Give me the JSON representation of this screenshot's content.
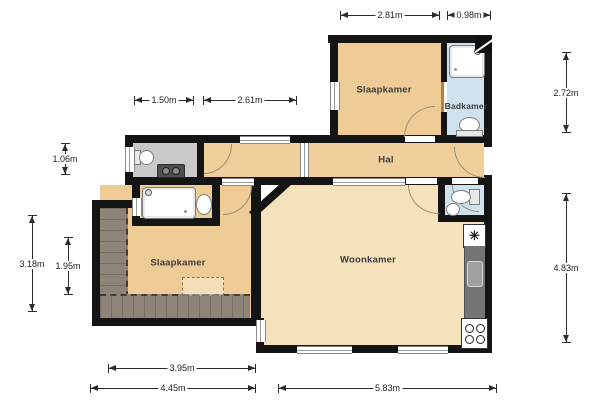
{
  "plan": {
    "rooms": {
      "bedroom_top": "Slaapkamer",
      "bathroom_top": "Badkamer",
      "hall": "Hal",
      "bedroom_left": "Slaapkamer",
      "living_room": "Woonkamer"
    },
    "dimensions": {
      "top_a": "2.81m",
      "top_b": "0.98m",
      "inner_a": "1.50m",
      "inner_b": "2.61m",
      "left_a": "1.06m",
      "left_b": "3.18m",
      "left_c": "1.95m",
      "right_a": "2.72m",
      "right_b": "4.83m",
      "bottom_a": "3.95m",
      "bottom_b": "4.45m",
      "bottom_c": "5.83m"
    },
    "symbols": {
      "fridge": "✳"
    },
    "colors": {
      "wall": "#141414",
      "room_tan": "#efcc96",
      "room_tan_light": "#f5e2bb",
      "bathroom_blue": "#cfe3ef",
      "wc_gray": "#c9c9c9",
      "slope_gray": "#8d8378",
      "counter_gray": "#757575"
    }
  }
}
